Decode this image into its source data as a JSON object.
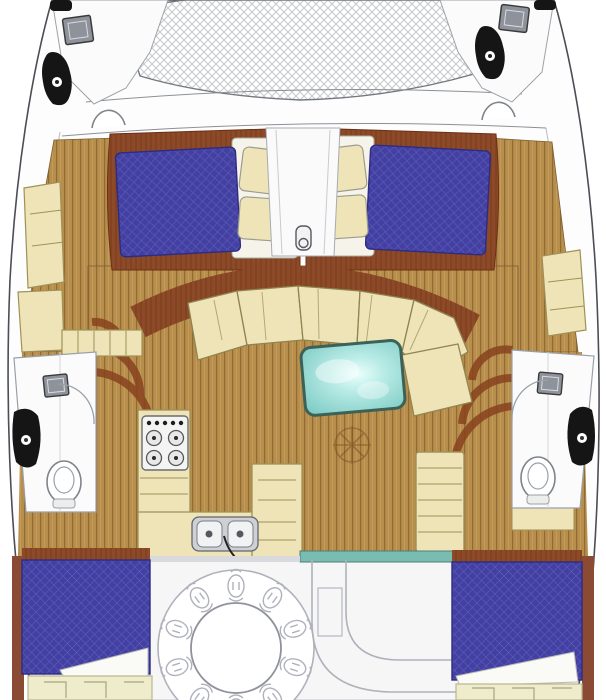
{
  "diagram": {
    "type": "catamaran-floor-plan",
    "view": "top-down deck and accommodation layout",
    "visible_text": ""
  },
  "rooms": {
    "trampoline": "Bow trampoline netting",
    "port_bow": "Port bow deck with hatch and windlass",
    "starboard_bow": "Starboard bow deck with hatch and windlass",
    "port_forward_cabin": "Port forward double cabin",
    "starboard_forward_cabin": "Starboard forward double cabin",
    "center_walkway": "Forward centerline walkway with mast step",
    "salon": "Main salon with curved settee and table",
    "galley": "Galley with stove and double sink",
    "port_head": "Port head with shower, sink and toilet",
    "starboard_head": "Starboard head with shower, sink and toilet",
    "port_aft_cabin": "Port aft double cabin",
    "starboard_aft_cabin": "Starboard aft double cabin",
    "cockpit": "Aft cockpit with round dining table and bench",
    "steps_starboard": "Companionway steps to starboard hull",
    "steps_port": "Companionway steps to port hull"
  },
  "furniture": {
    "beds": 4,
    "bed_cover": "blue quilted",
    "salon_table": "aqua glass table",
    "stove_burners": 4,
    "sink_bowls": 2,
    "toilets": 2
  },
  "colors": {
    "hullStroke": "#4a4e55",
    "deckWhite": "#fdfdfd",
    "net": "#c6c8cb",
    "blue": "#4340a4",
    "blueDark": "#2e2b80",
    "mahog": "#8c4a28",
    "mahogDark": "#6b3115",
    "woodBase": "#b88e4c",
    "woodLine": "#8f6b35",
    "woodLight": "#c79e5e",
    "cream": "#eee4b8",
    "creamStroke": "#9f9157",
    "teal": "#8fd6cf",
    "tealDark": "#3c6257",
    "tealDoor": "#79bdb2",
    "bathStroke": "#9aa0a8",
    "fixtureBlack": "#151515",
    "hatchGray": "#8e939b",
    "sketch": "#b0b2bb",
    "cockpitBg": "#f6f6f7"
  }
}
